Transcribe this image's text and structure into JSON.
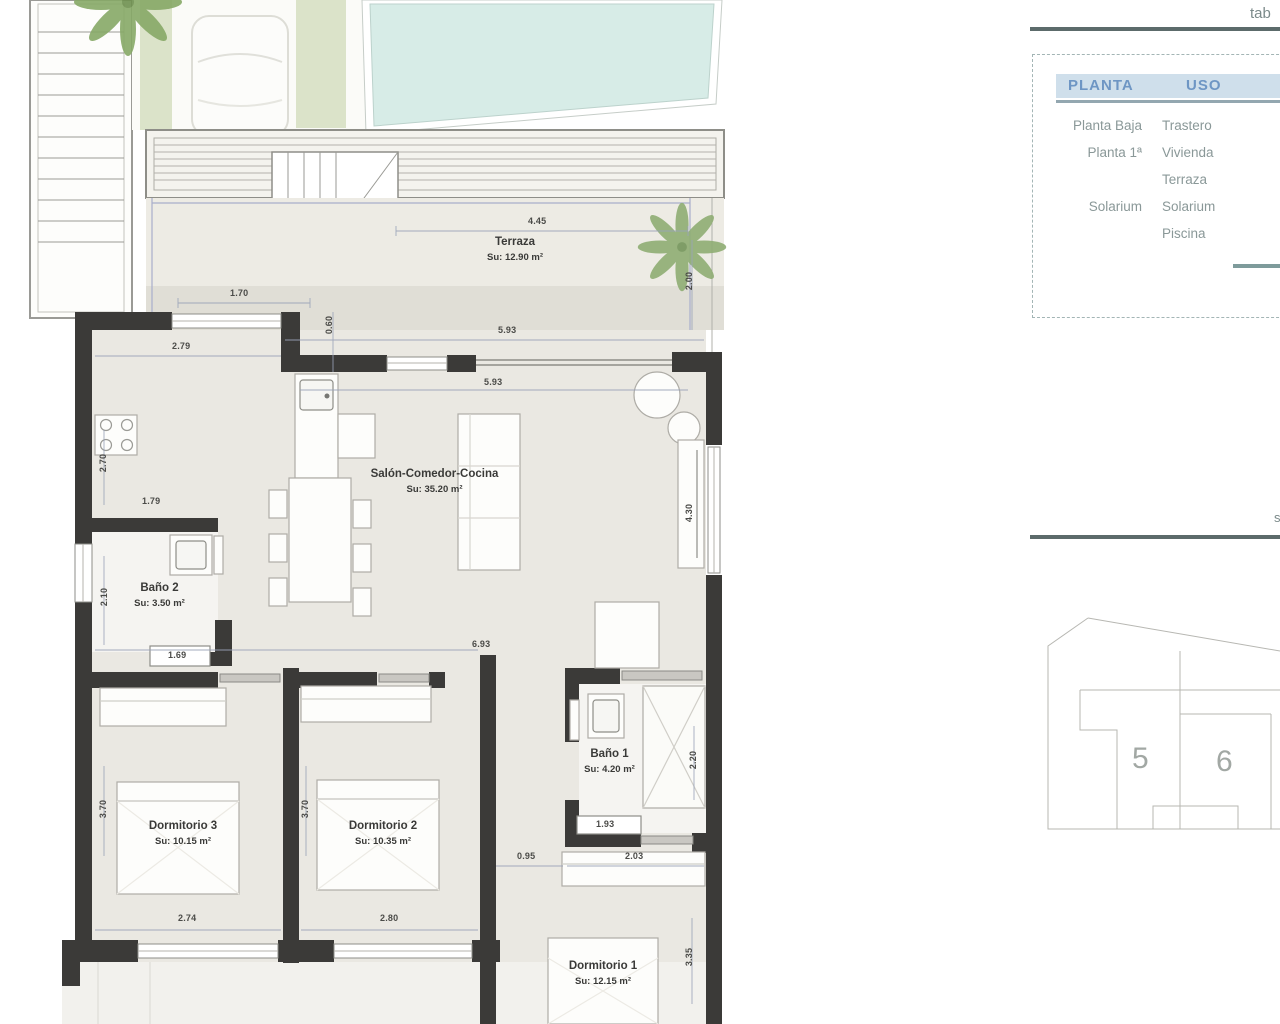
{
  "page": {
    "top_right_partial": "tab",
    "mid_right_partial": "s"
  },
  "summary_table": {
    "headers": {
      "planta": "PLANTA",
      "uso": "USO"
    },
    "rows": [
      {
        "planta": "Planta Baja",
        "uso": "Trastero"
      },
      {
        "planta": "Planta 1ª",
        "uso": "Vivienda"
      },
      {
        "planta": "",
        "uso": "Terraza"
      },
      {
        "planta": "Solarium",
        "uso": "Solarium"
      },
      {
        "planta": "",
        "uso": "Piscina"
      }
    ]
  },
  "site_plan": {
    "plot_left": "5",
    "plot_right": "6"
  },
  "rooms": {
    "terraza": {
      "name": "Terraza",
      "area": "Su: 12.90 m²"
    },
    "salon": {
      "name": "Salón-Comedor-Cocina",
      "area": "Su: 35.20 m²"
    },
    "bano2": {
      "name": "Baño 2",
      "area": "Su: 3.50 m²"
    },
    "bano1": {
      "name": "Baño 1",
      "area": "Su: 4.20 m²"
    },
    "dorm3": {
      "name": "Dormitorio 3",
      "area": "Su: 10.15 m²"
    },
    "dorm2": {
      "name": "Dormitorio 2",
      "area": "Su: 10.35 m²"
    },
    "dorm1": {
      "name": "Dormitorio 1",
      "area": "Su: 12.15 m²"
    }
  },
  "dims": {
    "terraza_w": "4.45",
    "terraza_left": "1.70",
    "terraza_h": "2.00",
    "wall_offset": "0.60",
    "kitchen_w": "2.79",
    "salon_top": "5.93",
    "salon_top2": "5.93",
    "kitchen_h": "2.70",
    "kitchen_inner": "1.79",
    "bano2_h": "2.10",
    "bano2_w": "1.69",
    "salon_w": "6.93",
    "salon_h": "4.30",
    "bano1_h": "2.20",
    "bano1_w": "1.93",
    "hall_w": "0.95",
    "dorm1_w": "2.03",
    "dorm3_w": "2.74",
    "dorm2_w": "2.80",
    "dorm3_h": "3.70",
    "dorm2_h": "3.70",
    "dorm1_h": "3.35"
  },
  "colors": {
    "wall": "#3b3a38",
    "pool": "#d7ece7",
    "floor": "#eae8e2",
    "terrace_floor": "#edebe4",
    "green_stripe": "#dbe3c9",
    "accent_line": "#5c6b6b",
    "table_header_bg": "#cfdfeb",
    "table_header_text": "#6e96c4",
    "table_text": "#8a9898",
    "railing": "#a9aecb"
  }
}
